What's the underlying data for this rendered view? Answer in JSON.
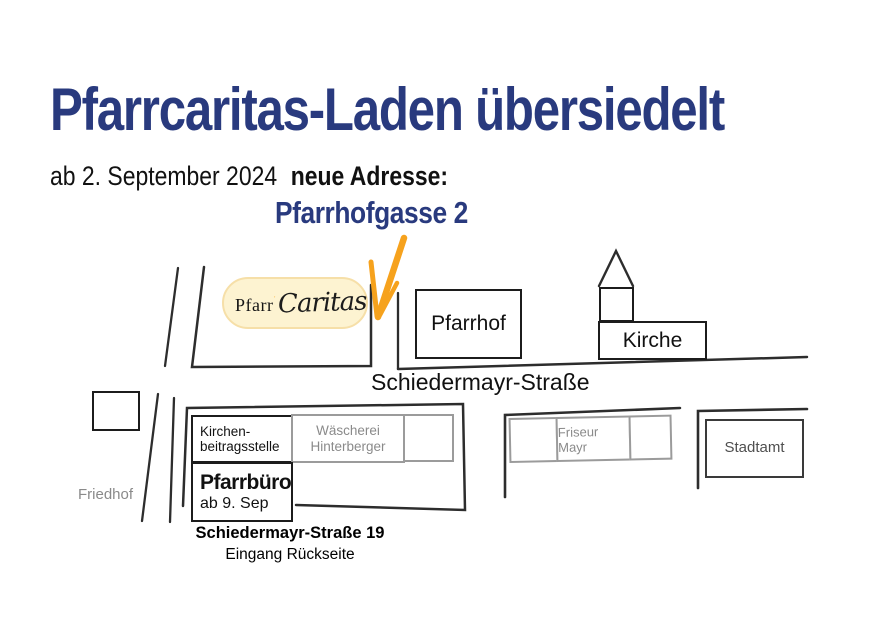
{
  "header": {
    "title": "Pfarrcaritas-Laden übersiedelt",
    "date_line": "ab 2. September 2024",
    "address_label": "neue Adresse:",
    "address": "Pfarrhofgasse 2"
  },
  "logo": {
    "prefix": "Pfarr",
    "name": "Caritas"
  },
  "map": {
    "street_label": "Schiedermayr-Straße",
    "pfarrhof": "Pfarrhof",
    "kirche": "Kirche",
    "friedhof": "Friedhof",
    "kirchenbeitrag": {
      "line1": "Kirchen-",
      "line2": "beitragsstelle"
    },
    "waescherei": {
      "line1": "Wäscherei",
      "line2": "Hinterberger"
    },
    "pfarrbuero": {
      "name": "Pfarrbüro",
      "date": "ab 9. Sep"
    },
    "friseur": "Friseur Mayr",
    "stadtamt": "Stadtamt",
    "note": {
      "line1": "Schiedermayr-Straße 19",
      "line2": "Eingang Rückseite"
    }
  },
  "icons": {
    "cross": "cross-icon",
    "arrow": "hand-drawn-arrow-icon",
    "spire": "church-spire-icon"
  },
  "colors": {
    "blue": "#293A7E",
    "orange": "#F6A21D",
    "logo_bg": "#FDF3D1",
    "logo_border": "#F6DFA8",
    "gray": "#8A8A8A",
    "line": "#2D2D2D",
    "box_gray": "#9B9B9B"
  }
}
